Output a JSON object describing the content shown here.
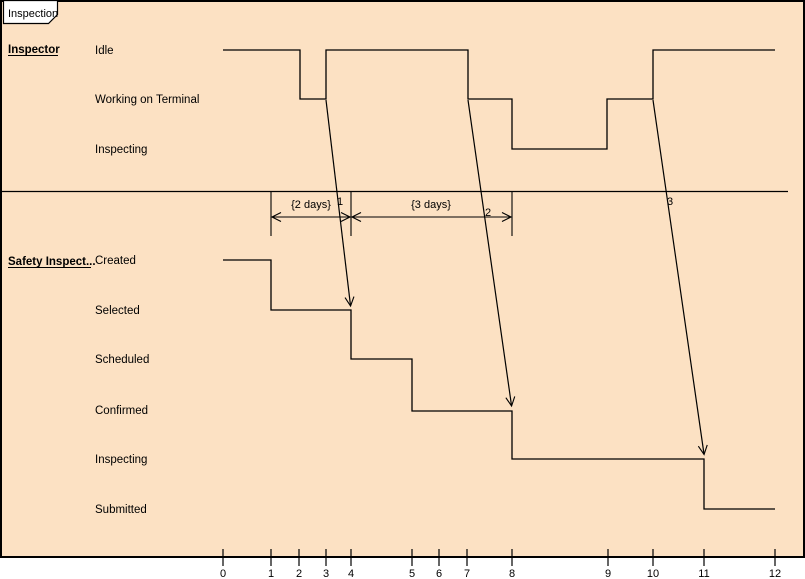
{
  "frame": {
    "title": "Inspection"
  },
  "colors": {
    "background": "#fce1c3",
    "tab_background": "#ffffff",
    "line": "#000000"
  },
  "lifelines": [
    {
      "name": "Inspector",
      "states": [
        "Idle",
        "Working on Terminal",
        "Inspecting"
      ],
      "segments": [
        {
          "state": "Idle",
          "from": 0,
          "to": 2
        },
        {
          "state": "Working on Terminal",
          "from": 2,
          "to": 3
        },
        {
          "state": "Idle",
          "from": 3,
          "to": 7
        },
        {
          "state": "Working on Terminal",
          "from": 7,
          "to": 8
        },
        {
          "state": "Inspecting",
          "from": 8,
          "to": 9
        },
        {
          "state": "Working on Terminal",
          "from": 9,
          "to": 10
        },
        {
          "state": "Idle",
          "from": 10,
          "to": 12
        }
      ]
    },
    {
      "name": "Safety Inspect...",
      "states": [
        "Created",
        "Selected",
        "Scheduled",
        "Confirmed",
        "Inspecting",
        "Submitted"
      ],
      "segments": [
        {
          "state": "Created",
          "from": 0,
          "to": 1
        },
        {
          "state": "Selected",
          "from": 1,
          "to": 4
        },
        {
          "state": "Scheduled",
          "from": 4,
          "to": 5
        },
        {
          "state": "Confirmed",
          "from": 5,
          "to": 8
        },
        {
          "state": "Inspecting",
          "from": 8,
          "to": 11
        },
        {
          "state": "Submitted",
          "from": 11,
          "to": 12
        }
      ]
    }
  ],
  "messages": [
    {
      "label": "1",
      "from_lifeline": "Inspector",
      "from_time": 3,
      "to_lifeline": "Safety Inspect...",
      "to_time": 4
    },
    {
      "label": "2",
      "from_lifeline": "Inspector",
      "from_time": 7,
      "to_lifeline": "Safety Inspect...",
      "to_time": 8
    },
    {
      "label": "3",
      "from_lifeline": "Inspector",
      "from_time": 10,
      "to_lifeline": "Safety Inspect...",
      "to_time": 11
    }
  ],
  "duration_constraints": [
    {
      "label": "{2 days}",
      "from_time": 1,
      "to_time": 4
    },
    {
      "label": "{3 days}",
      "from_time": 4,
      "to_time": 8
    }
  ],
  "axis": {
    "tick_labels": [
      "0",
      "1",
      "2",
      "3",
      "4",
      "5",
      "6",
      "7",
      "8",
      "9",
      "10",
      "11",
      "12"
    ]
  }
}
